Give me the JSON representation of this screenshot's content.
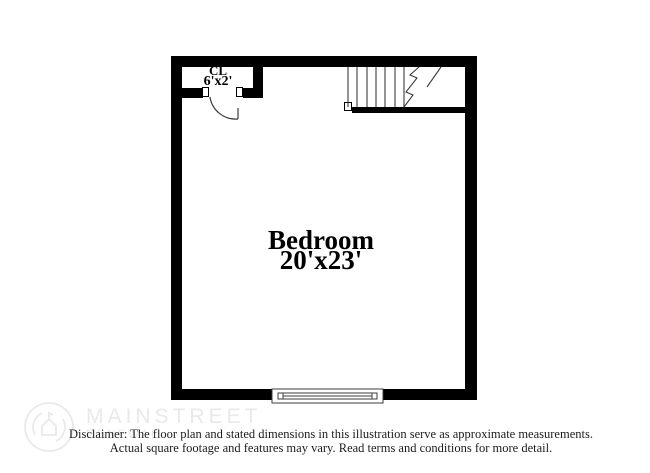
{
  "floor_plan": {
    "room": {
      "name": "Bedroom",
      "dimensions": "20'x23'"
    },
    "closet": {
      "name": "CL",
      "dimensions": "6'x2'"
    },
    "symbols": [
      "door-swing-arc",
      "staircase-up-cut-line",
      "window"
    ],
    "wall_color": "#000000"
  },
  "watermark": {
    "brand_line1": "MAINSTREET",
    "brand_line2": "RENEWAL",
    "logo_icon": "mainstreet-renewal-circle-logo",
    "color": "#e9e9e9"
  },
  "disclaimer": {
    "line1": "Disclaimer: The floor plan and stated dimensions in this illustration serve as approximate measurements.",
    "line2": "Actual square footage and features may vary. Read terms and conditions for more detail.",
    "text_color": "#1c1c1c"
  }
}
